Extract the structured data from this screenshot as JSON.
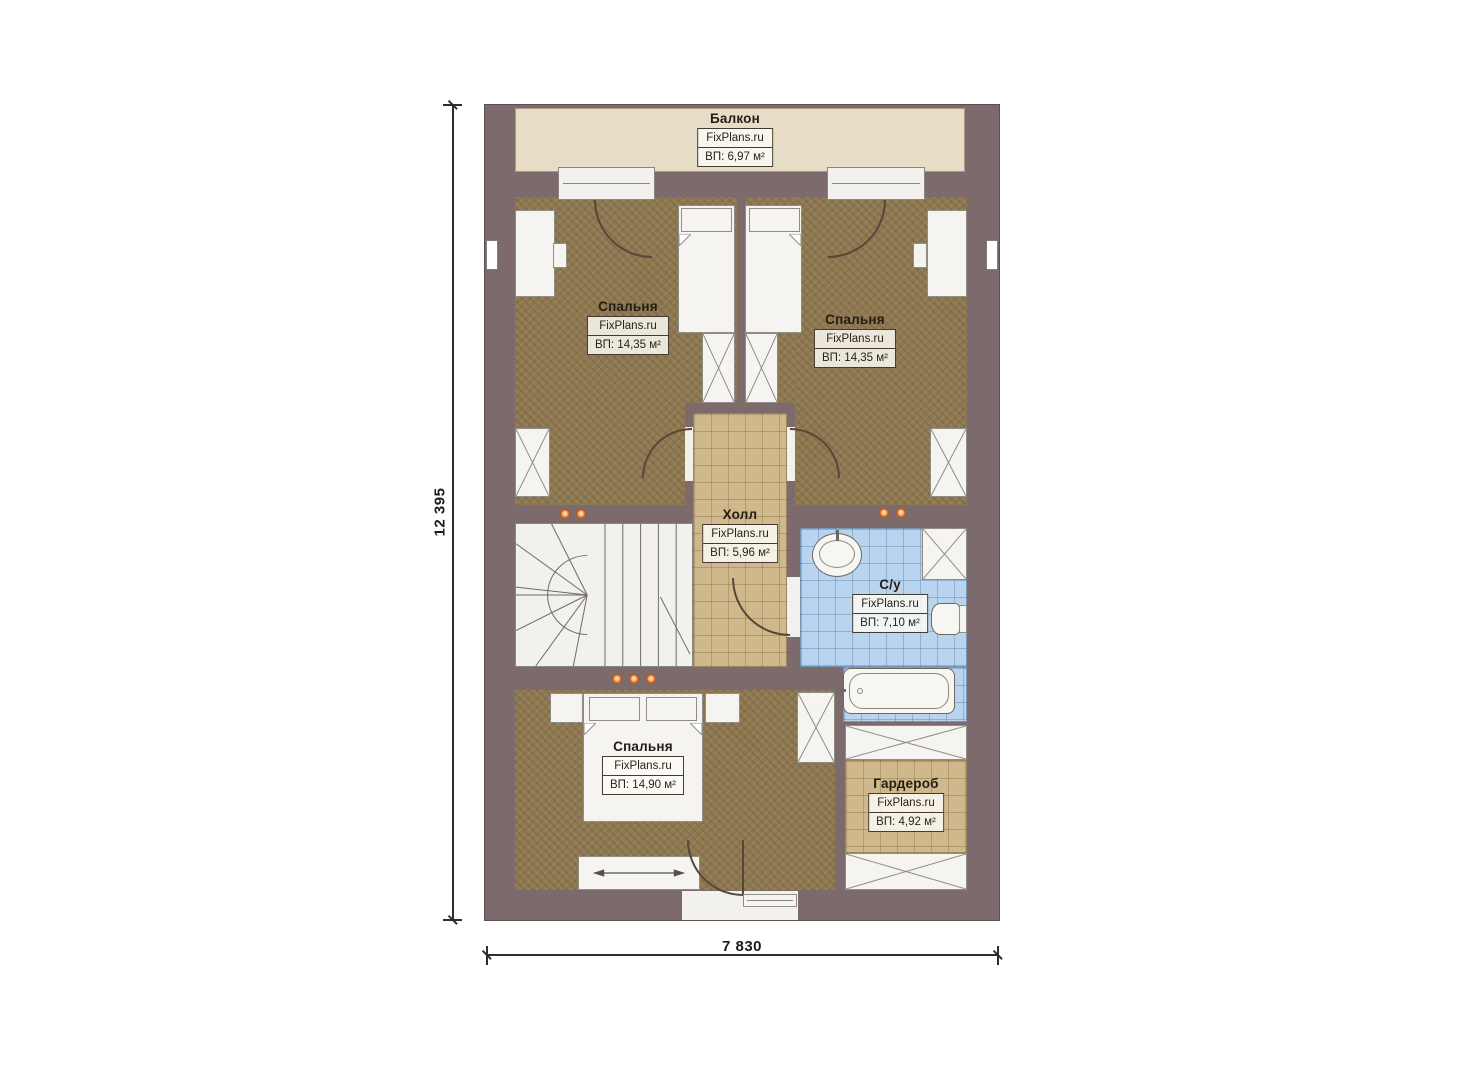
{
  "plan": {
    "dim_height": "12 395",
    "dim_width": "7 830",
    "rooms": {
      "balcony": {
        "name": "Балкон",
        "brand": "FixPlans.ru",
        "area": "ВП: 6,97 м²"
      },
      "bedroom_left": {
        "name": "Спальня",
        "brand": "FixPlans.ru",
        "area": "ВП: 14,35 м²"
      },
      "bedroom_right": {
        "name": "Спальня",
        "brand": "FixPlans.ru",
        "area": "ВП: 14,35 м²"
      },
      "hall": {
        "name": "Холл",
        "brand": "FixPlans.ru",
        "area": "ВП: 5,96 м²"
      },
      "bathroom": {
        "name": "С/у",
        "brand": "FixPlans.ru",
        "area": "ВП: 7,10 м²"
      },
      "bedroom_bottom": {
        "name": "Спальня",
        "brand": "FixPlans.ru",
        "area": "ВП: 14,90 м²"
      },
      "wardrobe": {
        "name": "Гардероб",
        "brand": "FixPlans.ru",
        "area": "ВП: 4,92 м²"
      }
    },
    "colors": {
      "wall": "#7c6a6c",
      "balcony_floor": "#e7ddc7",
      "bedroom_floor": "#8d7851",
      "tile_floor": "#cfb98c",
      "bath_floor": "#b9d4ee",
      "accent_dot": "#e87c2e"
    }
  }
}
